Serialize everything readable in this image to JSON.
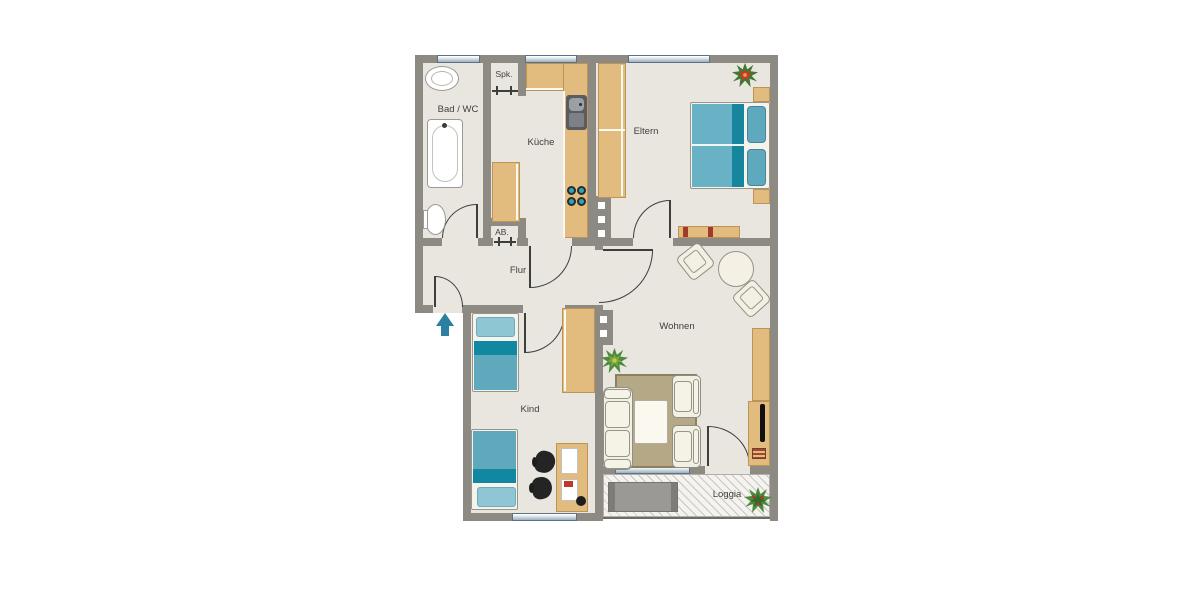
{
  "rooms": {
    "bad": {
      "label": "Bad / WC"
    },
    "spk": {
      "label": "Spk."
    },
    "kueche": {
      "label": "Küche"
    },
    "ab": {
      "label": "AB."
    },
    "flur": {
      "label": "Flur"
    },
    "eltern": {
      "label": "Eltern"
    },
    "kind": {
      "label": "Kind"
    },
    "wohnen": {
      "label": "Wohnen"
    },
    "loggia": {
      "label": "Loggia"
    }
  },
  "entrance_marker": "up-arrow",
  "colors": {
    "wall": "#8D8A83",
    "floor": "#E9E6E0",
    "furniture_wood": "#E2BC7E",
    "bedding_teal": "#60A9BD",
    "bedding_teal_dark": "#1187A2",
    "pillow_teal": "#8FC6D4",
    "upholstery_cream": "#F2EFE3",
    "rug_olive": "#B5A886",
    "window_blue": "#9FB5C6",
    "entry_arrow_teal": "#2B7FA0",
    "plant_green": "#4E8A3C",
    "flower_red": "#C43B2A"
  }
}
